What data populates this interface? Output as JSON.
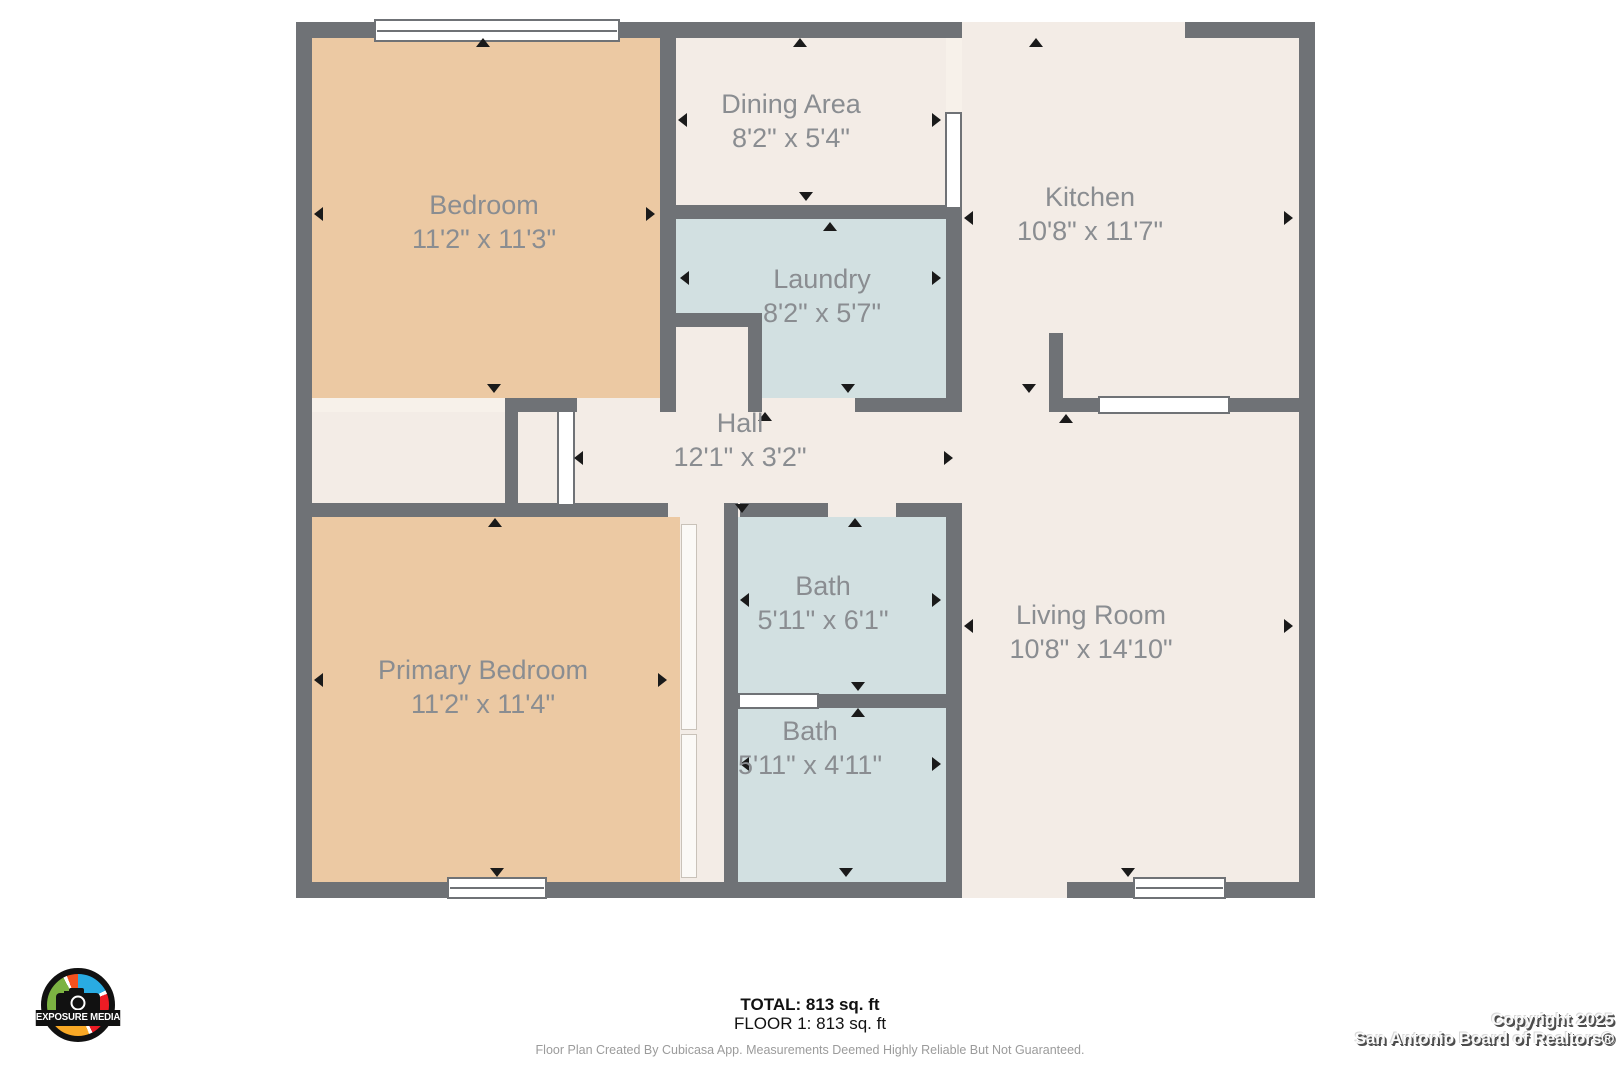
{
  "palette": {
    "wall": "#6f7276",
    "floor": "#f3ece6",
    "bedroom": "#ecc9a3",
    "bath": "#d2e0e1",
    "openLine": "#f7f1ea",
    "label": "#8a8d91",
    "arrow": "#1a1a1a",
    "footerText": "#111111",
    "disclaimer": "#9b9b9b"
  },
  "plan": {
    "rooms": [
      {
        "name": "Bedroom",
        "dims": "11'2\" x 11'3\""
      },
      {
        "name": "Dining Area",
        "dims": "8'2\" x 5'4\""
      },
      {
        "name": "Kitchen",
        "dims": "10'8\" x 11'7\""
      },
      {
        "name": "Laundry",
        "dims": "8'2\" x 5'7\""
      },
      {
        "name": "Hall",
        "dims": "12'1\" x 3'2\""
      },
      {
        "name": "Bath",
        "dims": "5'11\" x 6'1\""
      },
      {
        "name": "Bath",
        "dims": "5'11\" x 4'11\""
      },
      {
        "name": "Primary Bedroom",
        "dims": "11'2\" x 11'4\""
      },
      {
        "name": "Living Room",
        "dims": "10'8\" x 14'10\""
      }
    ]
  },
  "footer": {
    "total": "TOTAL: 813 sq. ft",
    "floor": "FLOOR 1: 813 sq. ft",
    "disclaimer": "Floor Plan Created By Cubicasa App. Measurements Deemed Highly Reliable But Not Guaranteed."
  },
  "copyright": {
    "line1": "Copyright 2025",
    "line2": "San Antonio Board of Realtors®"
  },
  "logo": {
    "text": "EXPOSURE MEDIA"
  }
}
